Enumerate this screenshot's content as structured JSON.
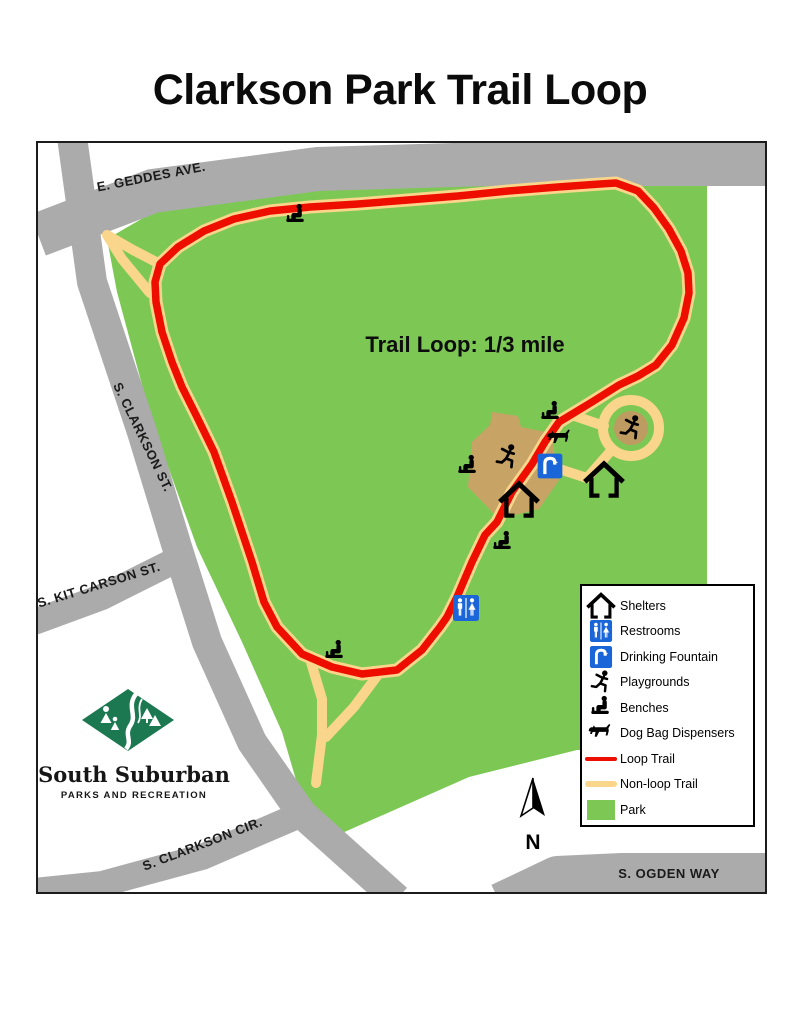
{
  "title": "Clarkson Park Trail Loop",
  "map": {
    "trail_annotation": "Trail Loop: 1/3 mile",
    "north_label": "N",
    "streets": {
      "geddes": "E. GEDDES AVE.",
      "clarkson_st": "S. CLARKSON ST.",
      "kit_carson": "S. KIT CARSON ST.",
      "clarkson_cir": "S. CLARKSON CIR.",
      "ogden": "S. OGDEN WAY"
    }
  },
  "legend": {
    "items": [
      {
        "icon": "shelter-icon",
        "label": "Shelters"
      },
      {
        "icon": "restroom-icon",
        "label": "Restrooms"
      },
      {
        "icon": "drinking-fountain-icon",
        "label": "Drinking Fountain"
      },
      {
        "icon": "playground-icon",
        "label": "Playgrounds"
      },
      {
        "icon": "bench-icon",
        "label": "Benches"
      },
      {
        "icon": "dog-bag-icon",
        "label": "Dog Bag Dispensers"
      },
      {
        "icon": "loop-trail-line",
        "label": "Loop Trail"
      },
      {
        "icon": "nonloop-trail-line",
        "label": "Non-loop Trail"
      },
      {
        "icon": "park-swatch",
        "label": "Park"
      }
    ]
  },
  "logo": {
    "org_name": "South Suburban",
    "org_tagline": "PARKS AND RECREATION"
  },
  "colors": {
    "park": "#7DC855",
    "road": "#ABABAB",
    "loop_trail": "#EE0E00",
    "nonloop_trail": "#FAD68C",
    "playground_area": "#C8A366",
    "playground_area_dark": "#BE9B60",
    "amenity_blue": "#1A65D8",
    "logo_green": "#1B7850"
  }
}
